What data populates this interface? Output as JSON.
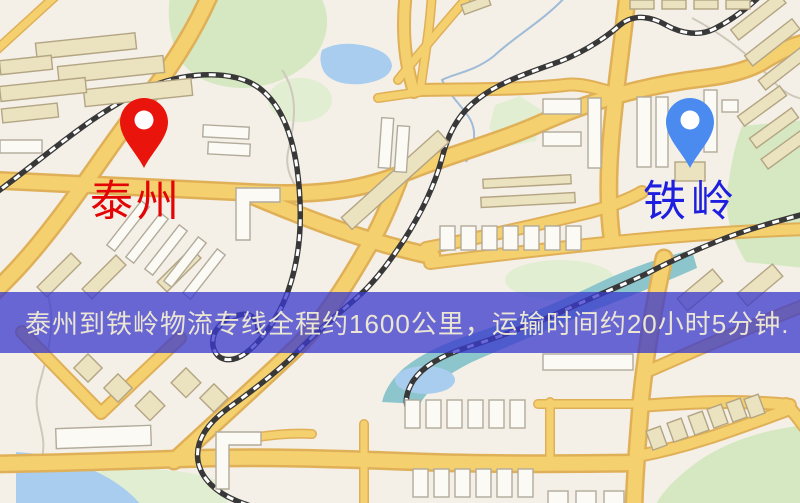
{
  "page": {
    "width": 800,
    "height": 503,
    "kind": "logistics-route-map-image"
  },
  "map": {
    "style": "stylized-city-street-map",
    "colors": {
      "background": "#f4f0e7",
      "road_fill": "#f4d06e",
      "road_border": "#e0b058",
      "railway": "#383838",
      "park": "#d5e8c2",
      "water": "#a9cdee",
      "river": "#8cc5cb",
      "building_tan": "#ebe2bf",
      "building_white": "#fcfaf4"
    }
  },
  "markers": {
    "origin": {
      "icon": "map-pin-icon",
      "label": "泰州",
      "pin_color": "#e9150c",
      "pin_hole_color": "#ffffff",
      "label_color": "#e30505",
      "x": 144,
      "y": 168
    },
    "destination": {
      "icon": "map-pin-icon",
      "label": "铁岭",
      "pin_color": "#4b8bf0",
      "pin_hole_color": "#ffffff",
      "label_color": "#1e1ee0",
      "x": 690,
      "y": 168
    }
  },
  "banner": {
    "text": "泰州到铁岭物流专线全程约1600公里，运输时间约20小时5分钟.",
    "background_color": "rgba(58,58,205,0.76)",
    "text_color": "#ebe5d3"
  },
  "route": {
    "origin": "泰州",
    "destination": "铁岭",
    "distance": "约1600公里",
    "duration": "约20小时5分钟"
  }
}
